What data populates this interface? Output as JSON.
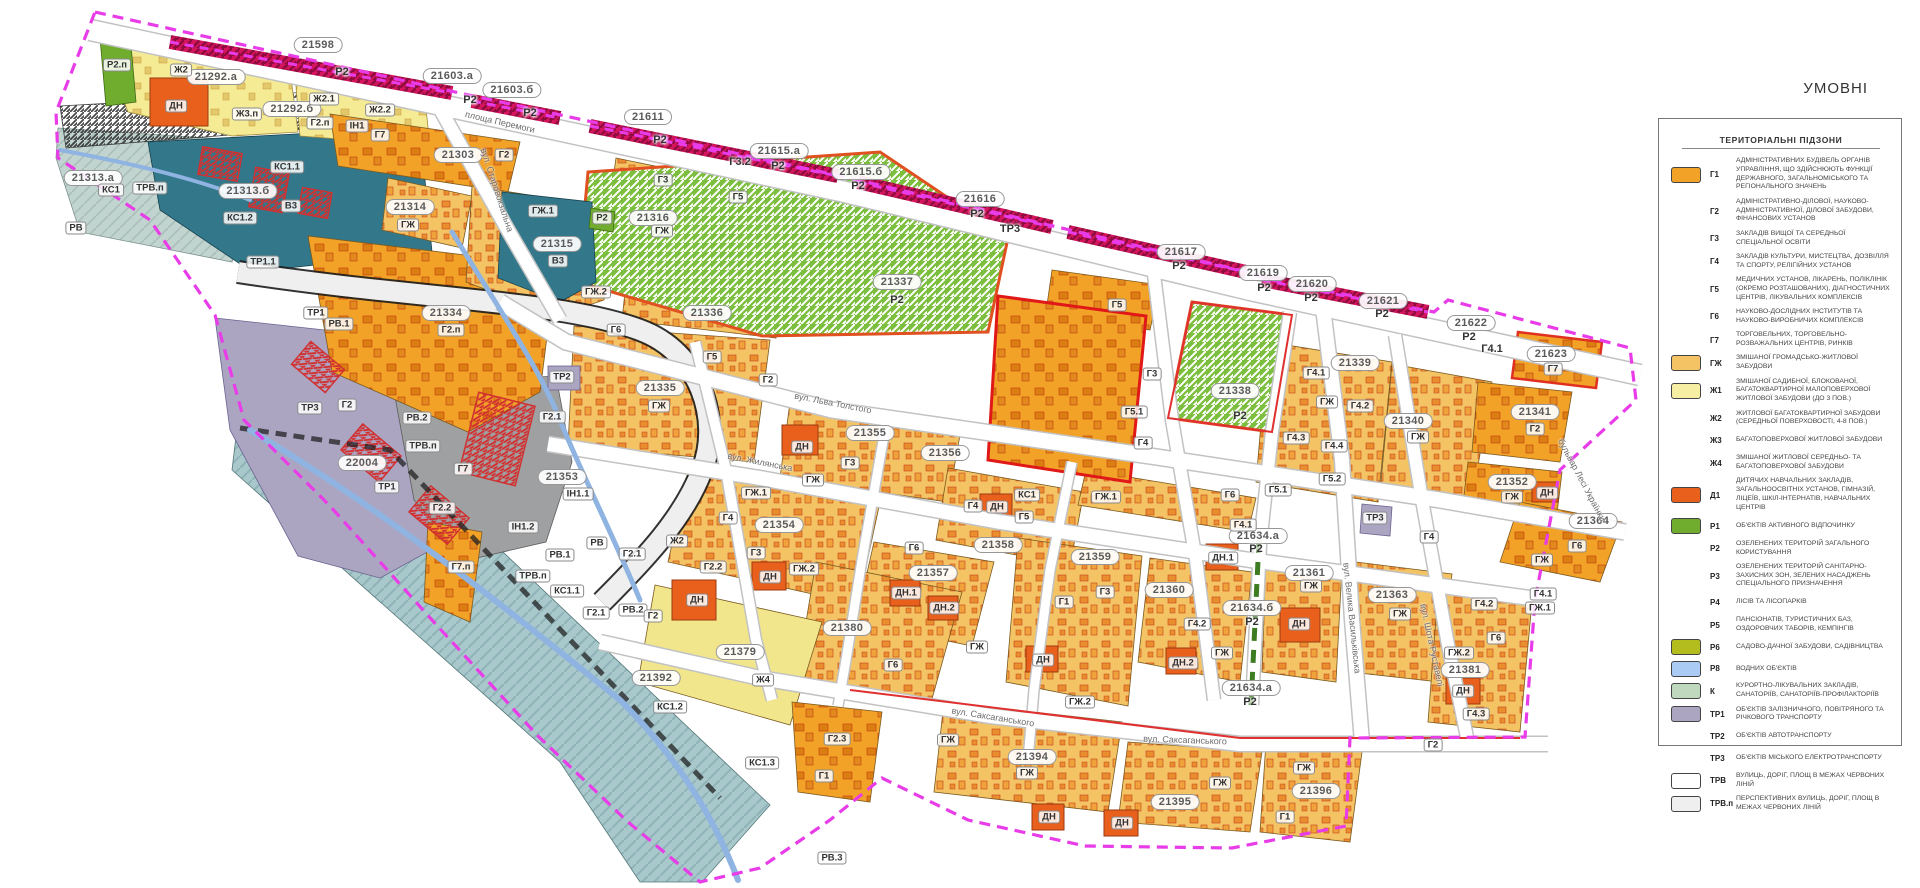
{
  "legend": {
    "title": "УМОВНІ",
    "header": "ТЕРИТОРІАЛЬНІ ПІДЗОНИ",
    "items": [
      {
        "code": "Г1",
        "swatch": "#F2A227",
        "text": "АДМІНІСТРАТИВНИХ БУДІВЕЛЬ ОРГАНІВ УПРАВЛІННЯ, ЩО ЗДІЙСНЮЮТЬ ФУНКЦІЇ ДЕРЖАВНОГО, ЗАГАЛЬНОМІСЬКОГО ТА РЕГІОНАЛЬНОГО ЗНАЧЕНЬ"
      },
      {
        "code": "Г2",
        "swatch": null,
        "text": "АДМІНІСТРАТИВНО-ДІЛОВОЇ, НАУКОВО-АДМІНІСТРАТИВНОЇ, ДІЛОВОЇ ЗАБУДОВИ, ФІНАНСОВИХ УСТАНОВ"
      },
      {
        "code": "Г3",
        "swatch": null,
        "text": "ЗАКЛАДІВ ВИЩОЇ ТА СЕРЕДНЬОЇ СПЕЦІАЛЬНОЇ ОСВІТИ"
      },
      {
        "code": "Г4",
        "swatch": null,
        "text": "ЗАКЛАДІВ КУЛЬТУРИ, МИСТЕЦТВА, ДОЗВІЛЛЯ ТА СПОРТУ, РЕЛІГІЙНИХ УСТАНОВ"
      },
      {
        "code": "Г5",
        "swatch": null,
        "text": "МЕДИЧНИХ УСТАНОВ, ЛІКАРЕНЬ, ПОЛІКЛІНІК (ОКРЕМО РОЗТАШОВАНИХ), ДІАГНОСТИЧНИХ ЦЕНТРІВ, ЛІКУВАЛЬНИХ КОМПЛЕКСІВ"
      },
      {
        "code": "Г6",
        "swatch": null,
        "text": "НАУКОВО-ДОСЛІДНИХ ІНСТИТУТІВ ТА НАУКОВО-ВИРОБНИЧИХ КОМПЛЕКСІВ"
      },
      {
        "code": "Г7",
        "swatch": null,
        "text": "ТОРГОВЕЛЬНИХ, ТОРГОВЕЛЬНО-РОЗВАЖАЛЬНИХ ЦЕНТРІВ, РИНКІВ"
      },
      {
        "code": "ГЖ",
        "swatch": "#F4C464",
        "text": "ЗМІШАНОЇ ГРОМАДСЬКО-ЖИТЛОВОЇ ЗАБУДОВИ"
      },
      {
        "code": "Ж1",
        "swatch": "#F6EFA3",
        "text": "ЗМІШАНОЇ САДИБНОЇ, БЛОКОВАНОЇ, БАГАТОКВАРТИРНОЇ МАЛОПОВЕРХОВОЇ ЖИТЛОВОЇ ЗАБУДОВИ (ДО 3 ПОВ.)"
      },
      {
        "code": "Ж2",
        "swatch": null,
        "text": "ЖИТЛОВОЇ БАГАТОКВАРТИРНОЇ ЗАБУДОВИ (СЕРЕДНЬОЇ ПОВЕРХОВОСТІ, 4-8 ПОВ.)"
      },
      {
        "code": "Ж3",
        "swatch": null,
        "text": "БАГАТОПОВЕРХОВОЇ ЖИТЛОВОЇ ЗАБУДОВИ"
      },
      {
        "code": "Ж4",
        "swatch": null,
        "text": "ЗМІШАНОЇ ЖИТЛОВОЇ СЕРЕДНЬО- ТА БАГАТОПОВЕРХОВОЇ ЗАБУДОВИ"
      },
      {
        "code": "Д1",
        "swatch": "#E8601C",
        "text": "ДИТЯЧИХ НАВЧАЛЬНИХ ЗАКЛАДІВ, ЗАГАЛЬНООСВІТНІХ УСТАНОВ, ГІМНАЗІЙ, ЛІЦЕЇВ, ШКІЛ-ІНТЕРНАТІВ, НАВЧАЛЬНИХ ЦЕНТРІВ"
      },
      {
        "code": "Р1",
        "swatch": "#70AD2E",
        "text": "ОБ'ЄКТІВ АКТИВНОГО ВІДПОЧИНКУ"
      },
      {
        "code": "Р2",
        "swatch": null,
        "text": "ОЗЕЛЕНЕНИХ ТЕРИТОРІЙ ЗАГАЛЬНОГО КОРИСТУВАННЯ"
      },
      {
        "code": "Р3",
        "swatch": null,
        "text": "ОЗЕЛЕНЕНИХ ТЕРИТОРІЙ САНІТАРНО-ЗАХИСНИХ ЗОН, ЗЕЛЕНИХ НАСАДЖЕНЬ СПЕЦІАЛЬНОГО ПРИЗНАЧЕННЯ"
      },
      {
        "code": "Р4",
        "swatch": null,
        "text": "ЛІСІВ ТА ЛІСОПАРКІВ"
      },
      {
        "code": "Р5",
        "swatch": null,
        "text": "ПАНСІОНАТІВ, ТУРИСТИЧНИХ БАЗ, ОЗДОРОВЧИХ ТАБОРІВ, КЕМПІНГІВ"
      },
      {
        "code": "Р6",
        "swatch": "#B4BD1E",
        "text": "САДОВО-ДАЧНОЇ ЗАБУДОВИ, САДІВНИЦТВА"
      },
      {
        "code": "Р8",
        "swatch": "#A9CBF4",
        "text": "ВОДНИХ ОБ'ЄКТІВ"
      },
      {
        "code": "К",
        "swatch": "#BFD8BE",
        "text": "КУРОРТНО-ЛІКУВАЛЬНИХ ЗАКЛАДІВ, САНАТОРІЇВ, САНАТОРІЇВ-ПРОФІЛАКТОРІЇВ"
      },
      {
        "code": "ТР1",
        "swatch": "#ABA5C2",
        "text": "ОБ'ЄКТІВ ЗАЛІЗНИЧНОГО, ПОВІТРЯНОГО ТА РІЧКОВОГО ТРАНСПОРТУ"
      },
      {
        "code": "ТР2",
        "swatch": null,
        "text": "ОБ'ЄКТІВ АВТОТРАНСПОРТУ"
      },
      {
        "code": "ТР3",
        "swatch": null,
        "text": "ОБ'ЄКТІВ МІСЬКОГО ЕЛЕКТРОТРАНСПОРТУ"
      },
      {
        "code": "ТРВ",
        "swatch": "#FFFFFF",
        "text": "ВУЛИЦЬ, ДОРІГ, ПЛОЩ В МЕЖАХ ЧЕРВОНИХ ЛІНІЙ"
      },
      {
        "code": "ТРВ.п",
        "swatch": "#EFEFEF",
        "text": "ПЕРСПЕКТИВНИХ ВУЛИЦЬ, ДОРІГ, ПЛОЩ В МЕЖАХ ЧЕРВОНИХ ЛІНІЙ"
      }
    ]
  },
  "map": {
    "streets": [
      [
        "площа Перемоги",
        500,
        122,
        13
      ],
      [
        "вул. Старовокзальна",
        497,
        190,
        72
      ],
      [
        "вул. Льва Толстого",
        833,
        403,
        11
      ],
      [
        "вул. Жилянська",
        760,
        462,
        11
      ],
      [
        "вул. Саксаганського",
        993,
        717,
        9
      ],
      [
        "вул. Саксаганського",
        1185,
        740,
        2
      ],
      [
        "вул. Велика Васильківська",
        1352,
        618,
        84
      ],
      [
        "вул. Шота Руставелі",
        1432,
        645,
        78
      ],
      [
        "бульвар Лесі Українки",
        1582,
        480,
        62
      ]
    ],
    "labels": [
      [
        "21598",
        318,
        45,
        "n"
      ],
      [
        "21603.а",
        452,
        76,
        "n"
      ],
      [
        "21603.б",
        512,
        90,
        "n"
      ],
      [
        "21611",
        648,
        117,
        "n"
      ],
      [
        "21615.а",
        779,
        151,
        "n"
      ],
      [
        "21615.б",
        861,
        172,
        "n"
      ],
      [
        "21616",
        980,
        199,
        "n"
      ],
      [
        "21617",
        1181,
        252,
        "n"
      ],
      [
        "21619",
        1263,
        273,
        "n"
      ],
      [
        "21620",
        1312,
        284,
        "n"
      ],
      [
        "21621",
        1383,
        301,
        "n"
      ],
      [
        "21622",
        1471,
        323,
        "n"
      ],
      [
        "21623",
        1551,
        354,
        "n"
      ],
      [
        "21292.а",
        216,
        77,
        "n"
      ],
      [
        "21292.б",
        292,
        109,
        "n"
      ],
      [
        "21303",
        458,
        155,
        "n"
      ],
      [
        "21313.а",
        93,
        178,
        "n"
      ],
      [
        "21313.б",
        248,
        191,
        "n"
      ],
      [
        "21314",
        410,
        207,
        "n"
      ],
      [
        "21315",
        557,
        244,
        "n"
      ],
      [
        "21316",
        653,
        218,
        "n"
      ],
      [
        "21334",
        446,
        313,
        "n"
      ],
      [
        "21335",
        660,
        388,
        "n"
      ],
      [
        "21336",
        707,
        313,
        "n"
      ],
      [
        "21337",
        897,
        282,
        "n"
      ],
      [
        "21338",
        1235,
        391,
        "n"
      ],
      [
        "21339",
        1355,
        363,
        "n"
      ],
      [
        "21340",
        1408,
        421,
        "n"
      ],
      [
        "21341",
        1535,
        412,
        "n"
      ],
      [
        "21352",
        1512,
        482,
        "n"
      ],
      [
        "21353",
        562,
        477,
        "n"
      ],
      [
        "21354",
        779,
        525,
        "n"
      ],
      [
        "21355",
        870,
        433,
        "n"
      ],
      [
        "21356",
        945,
        453,
        "n"
      ],
      [
        "21357",
        933,
        573,
        "n"
      ],
      [
        "21358",
        998,
        545,
        "n"
      ],
      [
        "21359",
        1095,
        557,
        "n"
      ],
      [
        "21360",
        1169,
        590,
        "n"
      ],
      [
        "21361",
        1309,
        573,
        "n"
      ],
      [
        "21363",
        1392,
        595,
        "n"
      ],
      [
        "21364",
        1593,
        521,
        "n"
      ],
      [
        "21379",
        740,
        652,
        "n"
      ],
      [
        "21380",
        847,
        628,
        "n"
      ],
      [
        "21381",
        1465,
        670,
        "n"
      ],
      [
        "21392",
        656,
        678,
        "n"
      ],
      [
        "21394",
        1032,
        757,
        "n"
      ],
      [
        "21395",
        1175,
        802,
        "n"
      ],
      [
        "21396",
        1316,
        791,
        "n"
      ],
      [
        "22004",
        362,
        463,
        "n"
      ],
      [
        "21634.а",
        1258,
        536,
        "n"
      ],
      [
        "21634.б",
        1252,
        608,
        "n"
      ],
      [
        "21634.а",
        1251,
        688,
        "n"
      ],
      [
        "Р2",
        342,
        72,
        "p"
      ],
      [
        "Р2",
        470,
        100,
        "p"
      ],
      [
        "Р2",
        530,
        113,
        "p"
      ],
      [
        "Р2",
        660,
        140,
        "p"
      ],
      [
        "Г3.2",
        740,
        162,
        "p"
      ],
      [
        "Р2",
        778,
        166,
        "p"
      ],
      [
        "Р2",
        858,
        186,
        "p"
      ],
      [
        "Р2",
        977,
        214,
        "p"
      ],
      [
        "ТР3",
        1010,
        229,
        "p"
      ],
      [
        "Р2",
        1179,
        266,
        "p"
      ],
      [
        "Р2",
        1264,
        288,
        "p"
      ],
      [
        "Р2",
        1311,
        298,
        "p"
      ],
      [
        "Р2",
        1382,
        314,
        "p"
      ],
      [
        "Р2",
        1469,
        337,
        "p"
      ],
      [
        "Г4.1",
        1492,
        349,
        "p"
      ],
      [
        "Р2",
        897,
        300,
        "p"
      ],
      [
        "Р2",
        1240,
        416,
        "p"
      ],
      [
        "Р2",
        1256,
        549,
        "p"
      ],
      [
        "Р2",
        1252,
        622,
        "p"
      ],
      [
        "Р2",
        1250,
        702,
        "p"
      ],
      [
        "Р2.п",
        117,
        65,
        "c"
      ],
      [
        "Ж2",
        181,
        70,
        "c"
      ],
      [
        "ДН",
        176,
        106,
        "c"
      ],
      [
        "Ж3.п",
        247,
        114,
        "c"
      ],
      [
        "Ж2.1",
        324,
        99,
        "c"
      ],
      [
        "Ж2.2",
        380,
        110,
        "c"
      ],
      [
        "Г2.п",
        320,
        123,
        "c"
      ],
      [
        "ІН1",
        357,
        126,
        "c"
      ],
      [
        "Г7",
        380,
        135,
        "c"
      ],
      [
        "Г2",
        504,
        155,
        "c"
      ],
      [
        "КС1",
        111,
        190,
        "c"
      ],
      [
        "ТРВ.п",
        150,
        188,
        "c"
      ],
      [
        "КС1.1",
        287,
        167,
        "c"
      ],
      [
        "В3",
        291,
        206,
        "c"
      ],
      [
        "КС1.2",
        240,
        218,
        "c"
      ],
      [
        "РВ",
        76,
        228,
        "c"
      ],
      [
        "ТР1.1",
        263,
        262,
        "c"
      ],
      [
        "ГЖ",
        408,
        225,
        "c"
      ],
      [
        "ГЖ.1",
        543,
        211,
        "c"
      ],
      [
        "В3",
        558,
        261,
        "c"
      ],
      [
        "ГЖ.2",
        596,
        292,
        "c"
      ],
      [
        "Г3",
        663,
        180,
        "c"
      ],
      [
        "ГЖ",
        662,
        231,
        "c"
      ],
      [
        "Г5",
        738,
        197,
        "c"
      ],
      [
        "Р2",
        602,
        218,
        "c"
      ],
      [
        "Г2.п",
        451,
        330,
        "c"
      ],
      [
        "ТР1",
        316,
        313,
        "c"
      ],
      [
        "РВ.1",
        339,
        324,
        "c"
      ],
      [
        "ТР3",
        310,
        408,
        "c"
      ],
      [
        "Г2",
        347,
        405,
        "c"
      ],
      [
        "ТР1",
        387,
        487,
        "c"
      ],
      [
        "РВ.2",
        417,
        418,
        "c"
      ],
      [
        "ТРВ.п",
        423,
        446,
        "c"
      ],
      [
        "Г7",
        463,
        469,
        "c"
      ],
      [
        "Г2.2",
        442,
        508,
        "c"
      ],
      [
        "Г2.1",
        552,
        417,
        "c"
      ],
      [
        "ТР2",
        562,
        377,
        "c"
      ],
      [
        "ІН1.1",
        578,
        494,
        "c"
      ],
      [
        "ІН1.2",
        523,
        527,
        "c"
      ],
      [
        "РВ",
        597,
        543,
        "c"
      ],
      [
        "РВ.1",
        560,
        555,
        "c"
      ],
      [
        "ТРВ.п",
        533,
        576,
        "c"
      ],
      [
        "КС1.1",
        567,
        591,
        "c"
      ],
      [
        "Г2.1",
        596,
        613,
        "c"
      ],
      [
        "РВ.2",
        633,
        610,
        "c"
      ],
      [
        "Г2",
        653,
        616,
        "c"
      ],
      [
        "Ж2",
        677,
        541,
        "c"
      ],
      [
        "ДН",
        697,
        600,
        "c"
      ],
      [
        "Г7.п",
        461,
        567,
        "c"
      ],
      [
        "КС1.2",
        670,
        707,
        "c"
      ],
      [
        "КС1.3",
        762,
        763,
        "c"
      ],
      [
        "Г2.3",
        837,
        739,
        "c"
      ],
      [
        "Г1",
        824,
        776,
        "c"
      ],
      [
        "Г6",
        616,
        330,
        "c"
      ],
      [
        "Г5",
        712,
        357,
        "c"
      ],
      [
        "Г2",
        768,
        380,
        "c"
      ],
      [
        "ГЖ",
        659,
        406,
        "c"
      ],
      [
        "Г4",
        728,
        518,
        "c"
      ],
      [
        "Г3",
        756,
        553,
        "c"
      ],
      [
        "ГЖ.1",
        756,
        493,
        "c"
      ],
      [
        "ДН",
        770,
        577,
        "c"
      ],
      [
        "ГЖ.2",
        804,
        569,
        "c"
      ],
      [
        "Г2.2",
        713,
        567,
        "c"
      ],
      [
        "Г2.1",
        632,
        554,
        "c"
      ],
      [
        "ДН",
        802,
        447,
        "c"
      ],
      [
        "Г3",
        850,
        463,
        "c"
      ],
      [
        "ГЖ",
        813,
        480,
        "c"
      ],
      [
        "Ж4",
        763,
        680,
        "c"
      ],
      [
        "Г6",
        893,
        665,
        "c"
      ],
      [
        "ДН.1",
        906,
        593,
        "c"
      ],
      [
        "ДН.2",
        944,
        608,
        "c"
      ],
      [
        "Г6",
        914,
        548,
        "c"
      ],
      [
        "ГЖ",
        977,
        647,
        "c"
      ],
      [
        "ГЖ",
        948,
        740,
        "c"
      ],
      [
        "ГЖ",
        1027,
        773,
        "c"
      ],
      [
        "ДН",
        1049,
        817,
        "c"
      ],
      [
        "ДН",
        1122,
        823,
        "c"
      ],
      [
        "ГЖ",
        1220,
        783,
        "c"
      ],
      [
        "Г1",
        1064,
        602,
        "c"
      ],
      [
        "Г3",
        1105,
        592,
        "c"
      ],
      [
        "ДН",
        1043,
        660,
        "c"
      ],
      [
        "ГЖ.2",
        1080,
        702,
        "c"
      ],
      [
        "Г4.2",
        1197,
        624,
        "c"
      ],
      [
        "ДН.2",
        1183,
        663,
        "c"
      ],
      [
        "ГЖ",
        1222,
        653,
        "c"
      ],
      [
        "ДН.1",
        1223,
        558,
        "c"
      ],
      [
        "Г5",
        1117,
        305,
        "c"
      ],
      [
        "Г3",
        1152,
        374,
        "c"
      ],
      [
        "Г4",
        1143,
        443,
        "c"
      ],
      [
        "Г5.1",
        1134,
        412,
        "c"
      ],
      [
        "КС1",
        1027,
        495,
        "c"
      ],
      [
        "Г4",
        973,
        506,
        "c"
      ],
      [
        "ДН",
        997,
        507,
        "c"
      ],
      [
        "Г5",
        1024,
        517,
        "c"
      ],
      [
        "ГЖ.1",
        1106,
        497,
        "c"
      ],
      [
        "Г6",
        1230,
        495,
        "c"
      ],
      [
        "Г4.1",
        1243,
        525,
        "c"
      ],
      [
        "Г4.1",
        1316,
        373,
        "c"
      ],
      [
        "ГЖ",
        1327,
        402,
        "c"
      ],
      [
        "Г4.2",
        1360,
        406,
        "c"
      ],
      [
        "Г4.3",
        1296,
        438,
        "c"
      ],
      [
        "Г4.4",
        1334,
        446,
        "c"
      ],
      [
        "Г5.2",
        1332,
        479,
        "c"
      ],
      [
        "Г5.1",
        1278,
        490,
        "c"
      ],
      [
        "ГЖ",
        1418,
        437,
        "c"
      ],
      [
        "Г2",
        1535,
        429,
        "c"
      ],
      [
        "Г7",
        1553,
        369,
        "c"
      ],
      [
        "ГЖ",
        1512,
        497,
        "c"
      ],
      [
        "ДН",
        1547,
        493,
        "c"
      ],
      [
        "Г6",
        1577,
        546,
        "c"
      ],
      [
        "ГЖ",
        1542,
        560,
        "c"
      ],
      [
        "ГЖ",
        1311,
        586,
        "c"
      ],
      [
        "ДН",
        1299,
        624,
        "c"
      ],
      [
        "ГЖ",
        1400,
        614,
        "c"
      ],
      [
        "ТР3",
        1375,
        518,
        "c"
      ],
      [
        "Г4",
        1429,
        537,
        "c"
      ],
      [
        "Г4.2",
        1484,
        604,
        "c"
      ],
      [
        "Г6",
        1496,
        638,
        "c"
      ],
      [
        "ГЖ.2",
        1459,
        653,
        "c"
      ],
      [
        "ДН",
        1463,
        691,
        "c"
      ],
      [
        "Г4.3",
        1476,
        714,
        "c"
      ],
      [
        "Г4.1",
        1543,
        594,
        "c"
      ],
      [
        "ГЖ.1",
        1540,
        608,
        "c"
      ],
      [
        "Г2",
        1433,
        745,
        "c"
      ],
      [
        "ГЖ",
        1304,
        768,
        "c"
      ],
      [
        "Г1",
        1285,
        817,
        "c"
      ],
      [
        "РВ.3",
        832,
        858,
        "c"
      ]
    ]
  },
  "colors": {
    "orange": "#F2A227",
    "gj": "#F4C464",
    "pale_yellow": "#F6EFA3",
    "yellow2": "#F5EB95",
    "j4": "#F2E68C",
    "dn_red": "#E8601C",
    "green": "#70AD2E",
    "park_green": "#7CBE3E",
    "olive": "#B4BD1E",
    "water_blue": "#A9CBF4",
    "kurort": "#BFD8BE",
    "tr_purple": "#ABA5C2",
    "teal": "#33788A",
    "ks_teal": "#A8C8CB",
    "gray_in": "#9FA0A2",
    "road_white": "#FFFFFF",
    "trv_p": "#EFEFEF",
    "boundary_magenta": "#E83CE8",
    "red_strip": "#D4145C",
    "river": "#8FB4E2"
  }
}
